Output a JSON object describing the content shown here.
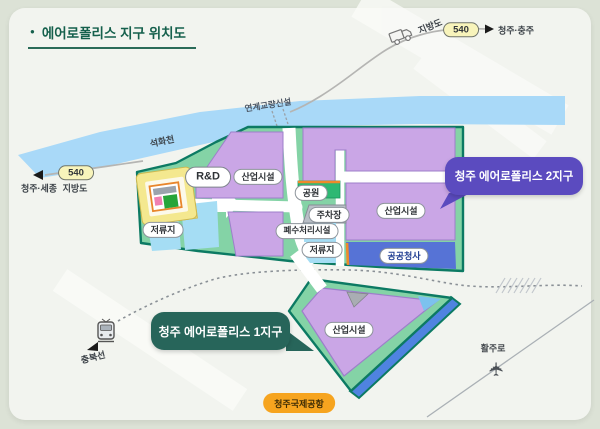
{
  "title": {
    "bullet": "●",
    "text": "에어로폴리스 지구 위치도"
  },
  "river": {
    "name": "석화천"
  },
  "bridge": {
    "label": "연계교량신설"
  },
  "road_right": {
    "name": "지방도",
    "number": "540",
    "arrow": "▶",
    "destination": "청주·충주"
  },
  "road_left": {
    "name": "지방도",
    "number": "540",
    "arrow": "◀",
    "destination": "청주·세종"
  },
  "district2": {
    "callout": "청주 에어로폴리스 2지구",
    "rnd": "R&D",
    "industry_left": "산업시설",
    "industry_right": "산업시설",
    "park": "공원",
    "parking": "주차장",
    "wastewater": "폐수처리시설",
    "retention_west": "저류지",
    "retention_mid": "저류지",
    "public_office": "공공청사"
  },
  "district1": {
    "callout": "청주 에어로폴리스 1지구",
    "industry": "산업시설"
  },
  "railway": {
    "name": "충북선"
  },
  "runway": {
    "label": "활주로"
  },
  "airport": {
    "label": "청주국제공항"
  },
  "airplane_glyph": "✈",
  "colors": {
    "district_border": "#0c7a63",
    "district_fill": "#84d3a6",
    "industry_purple": "#caa6e6",
    "water_blue": "#a5ddf4",
    "river_blue": "#a9d9f8",
    "public_office_blue": "#5673d6",
    "park_green": "#2eb873",
    "callout2_purple": "#5b4bbf",
    "callout1_green": "#27655a",
    "airport_orange": "#f6a41f",
    "accent_orange": "#ef8a2a",
    "road_yellow": "#f4e88f"
  }
}
